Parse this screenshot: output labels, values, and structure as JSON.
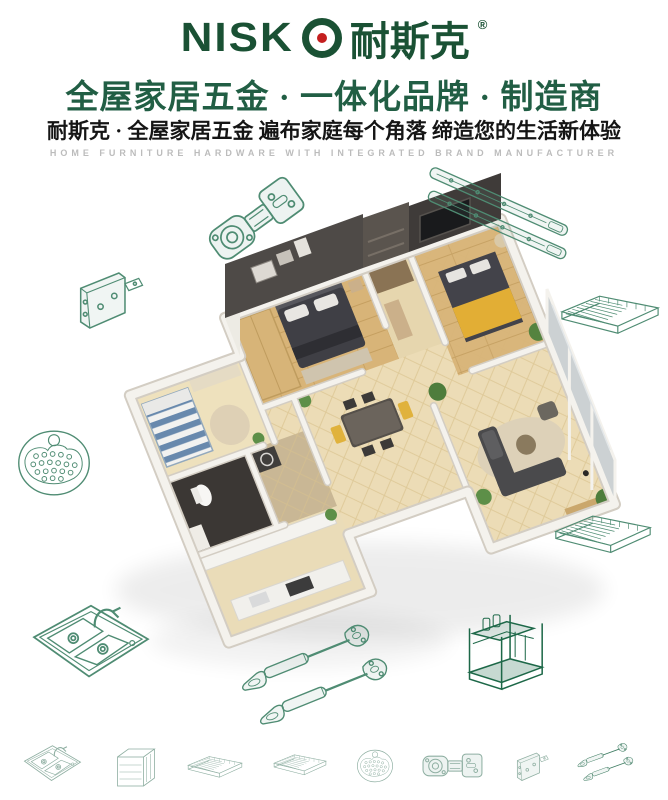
{
  "brand": {
    "latin_prefix": "NISK",
    "cn": "耐斯克",
    "registered": "®",
    "green": "#1a5134",
    "red": "#c41f1f"
  },
  "header": {
    "headline": "全屋家居五金 · 一体化品牌 · 制造商",
    "subheadline": "耐斯克 · 全屋家居五金  遍布家庭每个角落  缔造您的生活新体验",
    "tagline_en": "HOME FURNITURE HARDWARE WITH INTEGRATED BRAND MANUFACTURER",
    "headline_color": "#215e44"
  },
  "colors": {
    "lineart_green": "#4f8c73",
    "dark_green": "#1d6848",
    "floor_beige": "#ecdcb6",
    "wall_dark": "#4e4a47",
    "wood": "#d8b478",
    "accent_yellow": "#e2ae35"
  },
  "center_visual": {
    "name": "isometric-apartment-floor-plan-render",
    "rooms": [
      "master-bedroom",
      "second-bedroom",
      "kids-bedroom",
      "bathroom",
      "kitchen",
      "dining-room",
      "living-room",
      "window-wall"
    ]
  },
  "floating_items": [
    {
      "name": "cabinet-hinge"
    },
    {
      "name": "drawer-slide-rails"
    },
    {
      "name": "corner-bracket"
    },
    {
      "name": "wire-shelf-rack-top"
    },
    {
      "name": "round-strainer"
    },
    {
      "name": "wire-shelf-rack-side"
    },
    {
      "name": "double-bowl-sink"
    },
    {
      "name": "gas-strut-pair"
    },
    {
      "name": "spice-rack"
    }
  ],
  "bottom_row_items": [
    {
      "name": "double-bowl-sink"
    },
    {
      "name": "pullout-basket-cabinet"
    },
    {
      "name": "wire-drawer-basket"
    },
    {
      "name": "flat-wire-shelf"
    },
    {
      "name": "round-strainer"
    },
    {
      "name": "cabinet-hinge"
    },
    {
      "name": "corner-bracket"
    },
    {
      "name": "gas-strut-pair"
    }
  ]
}
